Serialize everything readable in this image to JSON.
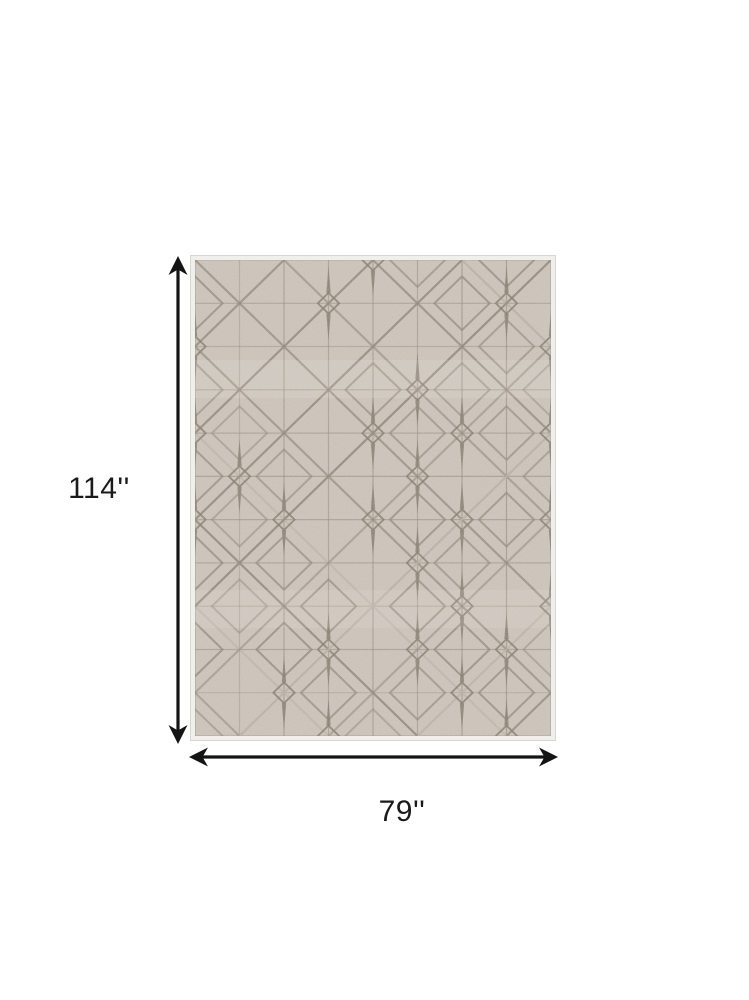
{
  "product_diagram": {
    "height_label": "114''",
    "width_label": "79''"
  },
  "icons": {
    "vertical_arrow": "double-headed-vertical-arrow",
    "horizontal_arrow": "double-headed-horizontal-arrow"
  },
  "colors": {
    "dimension_line": "#141414",
    "label_text": "#1a1a1a",
    "rug_field": "#c7bfb5",
    "rug_border": "#f1efec",
    "rug_border_edge": "#d8d6d2",
    "rug_pattern_dark": "#8b8275",
    "rug_pattern_light": "#b3aba0",
    "rug_motif": "#7e7567"
  }
}
